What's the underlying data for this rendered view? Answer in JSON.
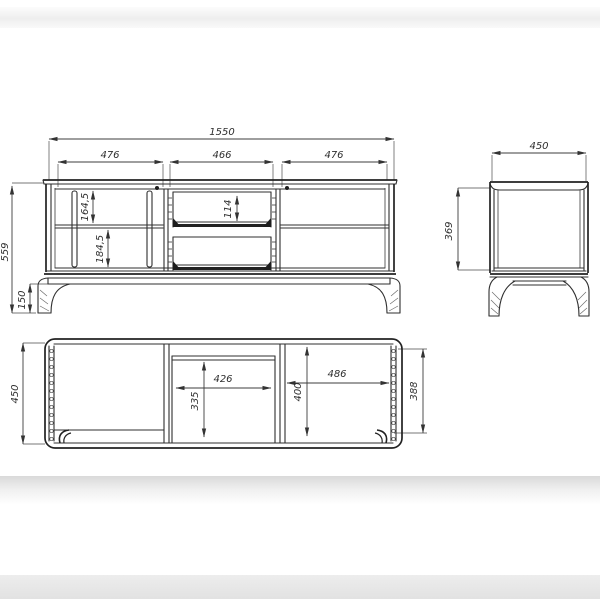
{
  "dims": {
    "front": {
      "total_width": "1550",
      "section_left": "476",
      "section_middle": "466",
      "section_right": "476",
      "height_total": "559",
      "leg_height": "150",
      "opening_upper": "164,5",
      "opening_lower": "184,5",
      "drawer_opening": "114"
    },
    "side": {
      "depth": "450",
      "body_height": "369"
    },
    "plan": {
      "depth": "450",
      "middle_width": "426",
      "middle_depth": "335",
      "right_width": "486",
      "right_depth": "400",
      "inner_depth": "388"
    }
  }
}
